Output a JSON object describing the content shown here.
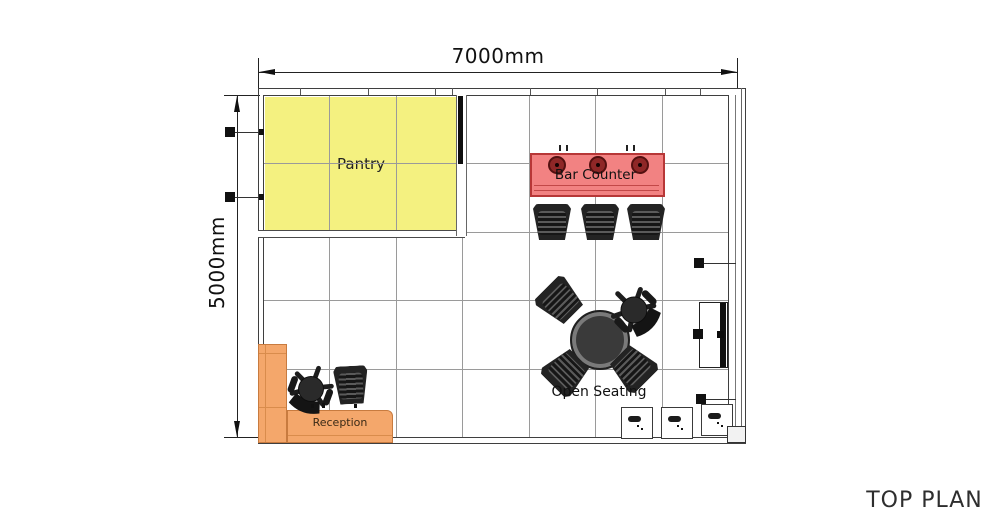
{
  "title": "TOP PLAN",
  "dimensions": {
    "width": "7000mm",
    "height": "5000mm"
  },
  "areas": {
    "pantry": {
      "label": "Pantry",
      "fill": "#F4F180"
    },
    "bar_counter": {
      "label": "Bar Counter",
      "fill": "#F28282",
      "border": "#B73737",
      "tap_count": 3,
      "stool_count": 3
    },
    "open_seating": {
      "label": "Open Seating",
      "chair_count": 4,
      "table": "round"
    },
    "reception": {
      "label": "Reception",
      "fill": "#F4A76B",
      "border": "#C87B3F"
    }
  },
  "icons": {
    "dimension_arrow": "engineering arrowhead",
    "wall_marker": "black square",
    "floor_box": "outlet box with pill and dots",
    "bar_tap": "dark red circle",
    "door_panel": "hinged panel on right wall"
  },
  "colors": {
    "wall": "#3F3F3F",
    "grid": "#9A9A9A",
    "furniture_dark": "#262626",
    "dimension_text": "#111111",
    "title_text": "#2E2E2E"
  }
}
